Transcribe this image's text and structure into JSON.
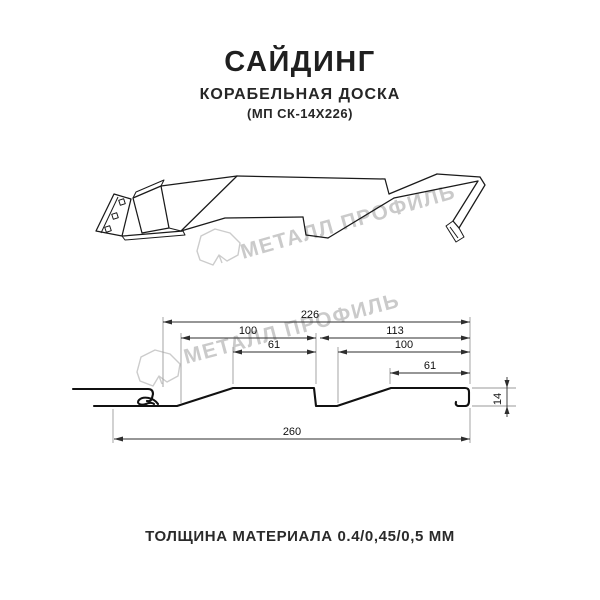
{
  "header": {
    "title": "САЙДИНГ",
    "subtitle": "КОРАБЕЛЬНАЯ ДОСКА",
    "code": "(МП СК-14Х226)"
  },
  "watermark": {
    "text": "МЕТАЛЛ ПРОФИЛЬ",
    "logo_icon": "metall-profil-logo",
    "color": "#cacaca"
  },
  "drawing": {
    "type": "siding-profile-technical-drawing",
    "views": [
      "3d-perspective-sketch",
      "cross-section-with-dimensions"
    ]
  },
  "dimensions": {
    "coverage_width": "226",
    "left_module_width": "100",
    "left_top_width": "61",
    "right_module_width": "113",
    "right_inner_width": "100",
    "right_top_width": "61",
    "overall_width": "260",
    "profile_height": "14"
  },
  "footer": {
    "thickness_note": "ТОЛЩИНА МАТЕРИАЛА 0.4/0,45/0,5 ММ"
  },
  "colors": {
    "line": "#1a1a1a",
    "dimension_line": "#2e2e2e",
    "extension_line": "#9a9a9a",
    "text": "#222222"
  }
}
